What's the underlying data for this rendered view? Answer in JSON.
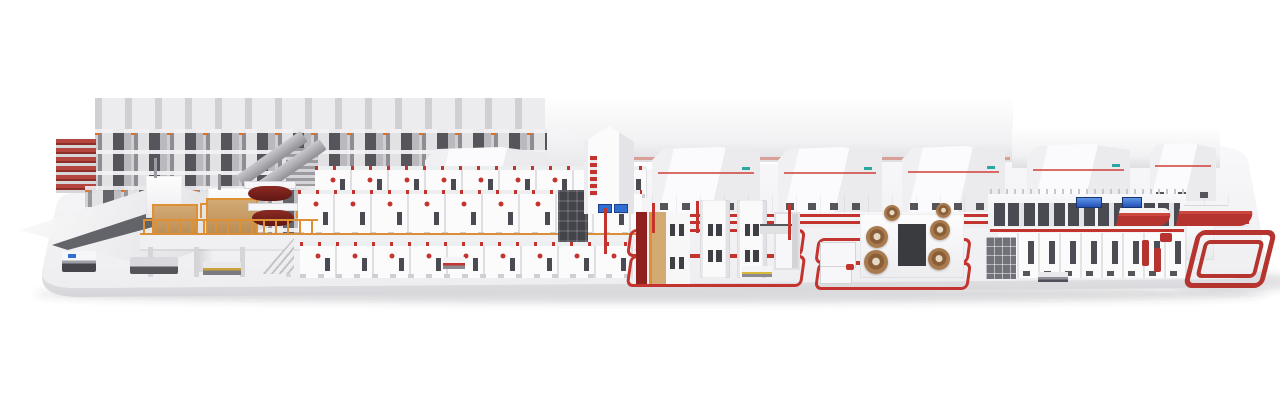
{
  "image": {
    "type": "3d-render",
    "subject": "Complete corrugated board production line (roll storage, wet end with mezzanine corrugator, roll handling stations, dry end, roller conveyors) displayed on a rounded white plinth",
    "background_color": "#ffffff",
    "visible_text": []
  },
  "palette": {
    "accent_red": "#c3342e",
    "dark_red": "#8e211d",
    "orange": "#e09034",
    "tan": "#d3aa74",
    "roll_brown": "#a97a4e",
    "maroon_roll": "#7a2520",
    "machine_white": "#fafafb",
    "machine_shade": "#ececef",
    "seam_gray": "#d9d9dc",
    "rack_gray": "#a4a4aa",
    "rack_slot": "#55555b",
    "window_dark": "#4a4a52",
    "screen_blue": "#2f6fd0",
    "logo_teal": "#2aa7a0",
    "dark_panel": "#3f3f46",
    "wall_light": "#ebebee",
    "plinth_top": "#f3f3f5",
    "plinth_face": "#e4e4e7"
  }
}
